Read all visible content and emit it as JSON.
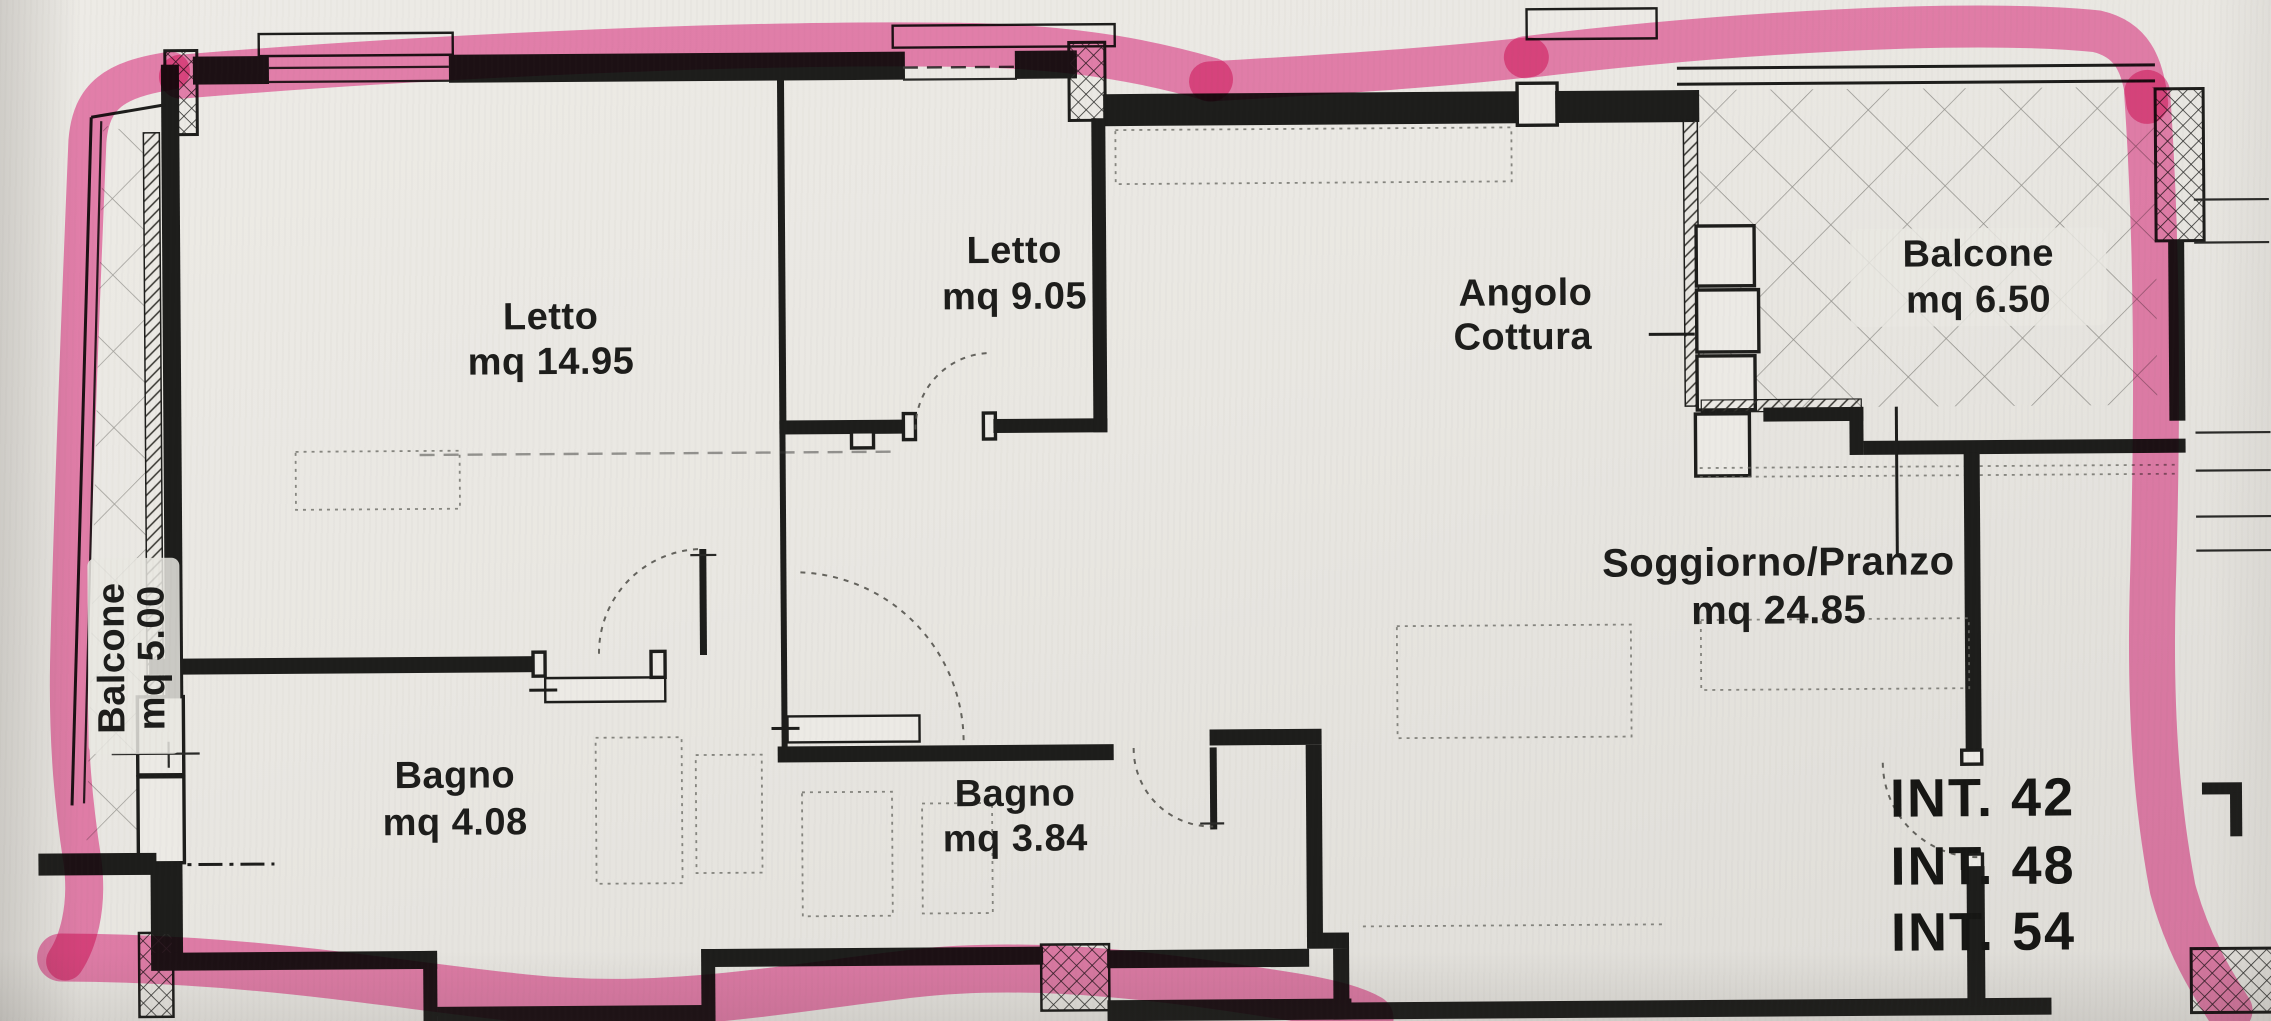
{
  "document": {
    "type": "apartment floor plan scan with highlighter",
    "highlight_color": "#f05fa5",
    "ink_color": "#1d1d1b",
    "paper_color": "#e9e7e2"
  },
  "rooms": {
    "letto1": {
      "name": "Letto",
      "area": "mq 14.95"
    },
    "letto2": {
      "name": "Letto",
      "area": "mq 9.05"
    },
    "angolo_cottura": {
      "name_line1": "Angolo",
      "name_line2": "Cottura"
    },
    "balcone_dx": {
      "name": "Balcone",
      "area": "mq 6.50"
    },
    "balcone_sx": {
      "name": "Balcone",
      "area": "mq 5.00"
    },
    "soggiorno": {
      "name": "Soggiorno/Pranzo",
      "area": "mq 24.85"
    },
    "bagno1": {
      "name": "Bagno",
      "area": "mq 4.08"
    },
    "bagno2": {
      "name": "Bagno",
      "area": "mq 3.84"
    }
  },
  "interni": [
    "INT. 42",
    "INT. 48",
    "INT. 54"
  ]
}
